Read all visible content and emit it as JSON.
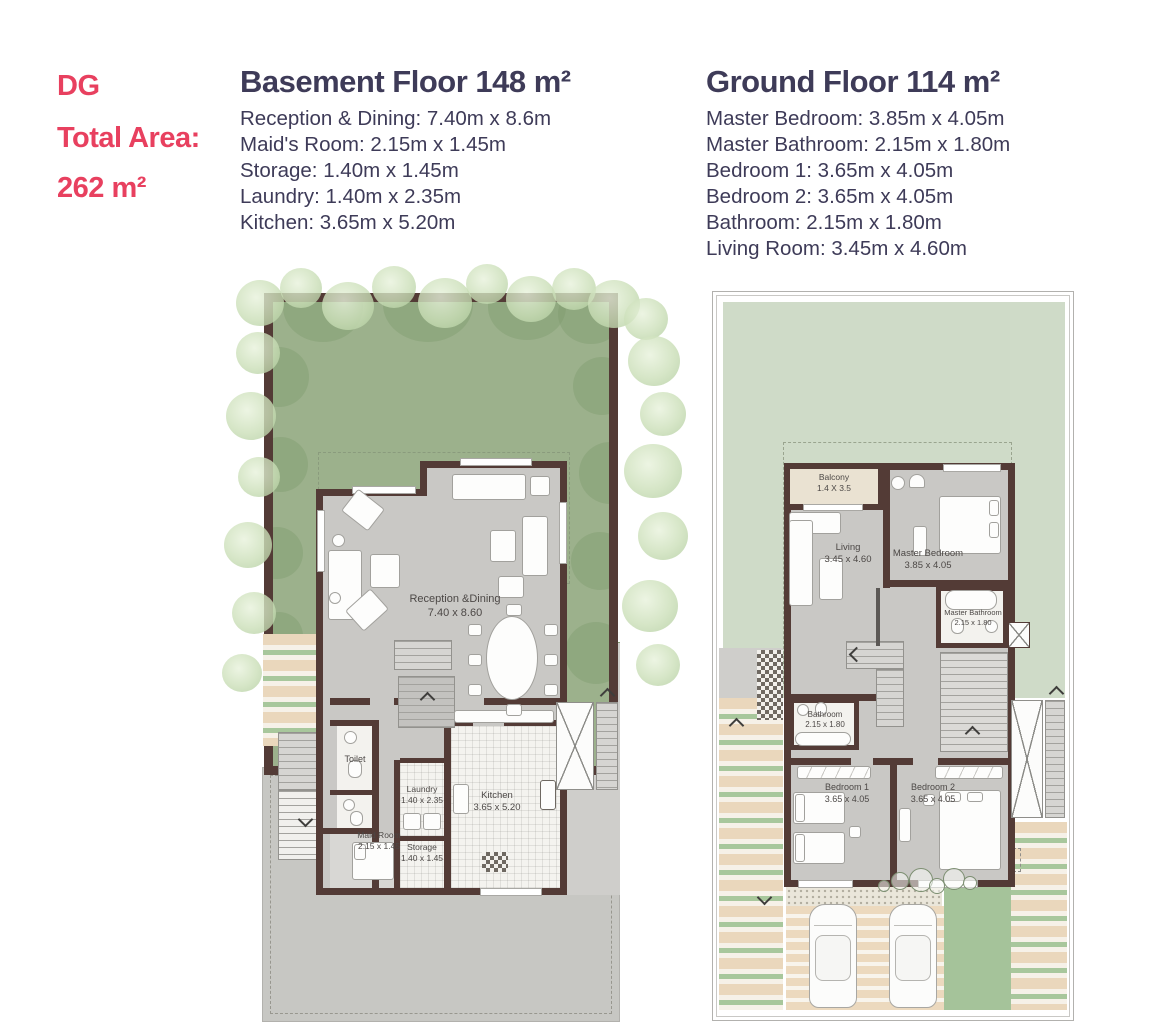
{
  "header": {
    "unit_code": "DG",
    "total_area_label": "Total Area:",
    "total_area_value": "262 m²"
  },
  "basement": {
    "title": "Basement Floor 148 m²",
    "specs": [
      "Reception & Dining: 7.40m x 8.6m",
      "Maid's Room: 2.15m x 1.45m",
      "Storage: 1.40m x 1.45m",
      "Laundry: 1.40m x 2.35m",
      "Kitchen: 3.65m x 5.20m"
    ],
    "plan": {
      "reception": {
        "name": "Reception &Dining",
        "dims": "7.40 x 8.60"
      },
      "toilet": {
        "name": "Toilet"
      },
      "maid": {
        "name": "Maid Room",
        "dims": "2.15 x 1.45"
      },
      "laundry": {
        "name": "Laundry",
        "dims": "1.40 x 2.35"
      },
      "storage": {
        "name": "Storage",
        "dims": "1.40 x 1.45"
      },
      "kitchen": {
        "name": "Kitchen",
        "dims": "3.65 x 5.20"
      }
    }
  },
  "ground": {
    "title": "Ground Floor 114 m²",
    "specs": [
      "Master Bedroom: 3.85m x 4.05m",
      "Master Bathroom: 2.15m x 1.80m",
      "Bedroom 1: 3.65m x 4.05m",
      "Bedroom 2: 3.65m x 4.05m",
      "Bathroom: 2.15m x 1.80m",
      "Living Room: 3.45m x 4.60m"
    ],
    "plan": {
      "balcony": {
        "name": "Balcony",
        "dims": "1.4 X 3.5"
      },
      "living": {
        "name": "Living",
        "dims": "3.45 x 4.60"
      },
      "master_bedroom": {
        "name": "Master Bedroom",
        "dims": "3.85 x 4.05"
      },
      "master_bathroom": {
        "name": "Master Bathroom",
        "dims": "2.15 x 1.80"
      },
      "bathroom": {
        "name": "Bathroom",
        "dims": "2.15 x 1.80"
      },
      "bedroom1": {
        "name": "Bedroom 1",
        "dims": "3.65 x 4.05"
      },
      "bedroom2": {
        "name": "Bedroom 2",
        "dims": "3.65 x 4.05"
      }
    }
  },
  "colors": {
    "accent_pink": "#E8405F",
    "heading_navy": "#3E3B58",
    "wall_brown": "#533B36",
    "garden_green": "#9CB18C",
    "lawn_light_green": "#CFDBC8",
    "floor_gray": "#C9C8C5",
    "paving_beige": "#EAD7BC",
    "strip_green": "#A8C79C"
  }
}
